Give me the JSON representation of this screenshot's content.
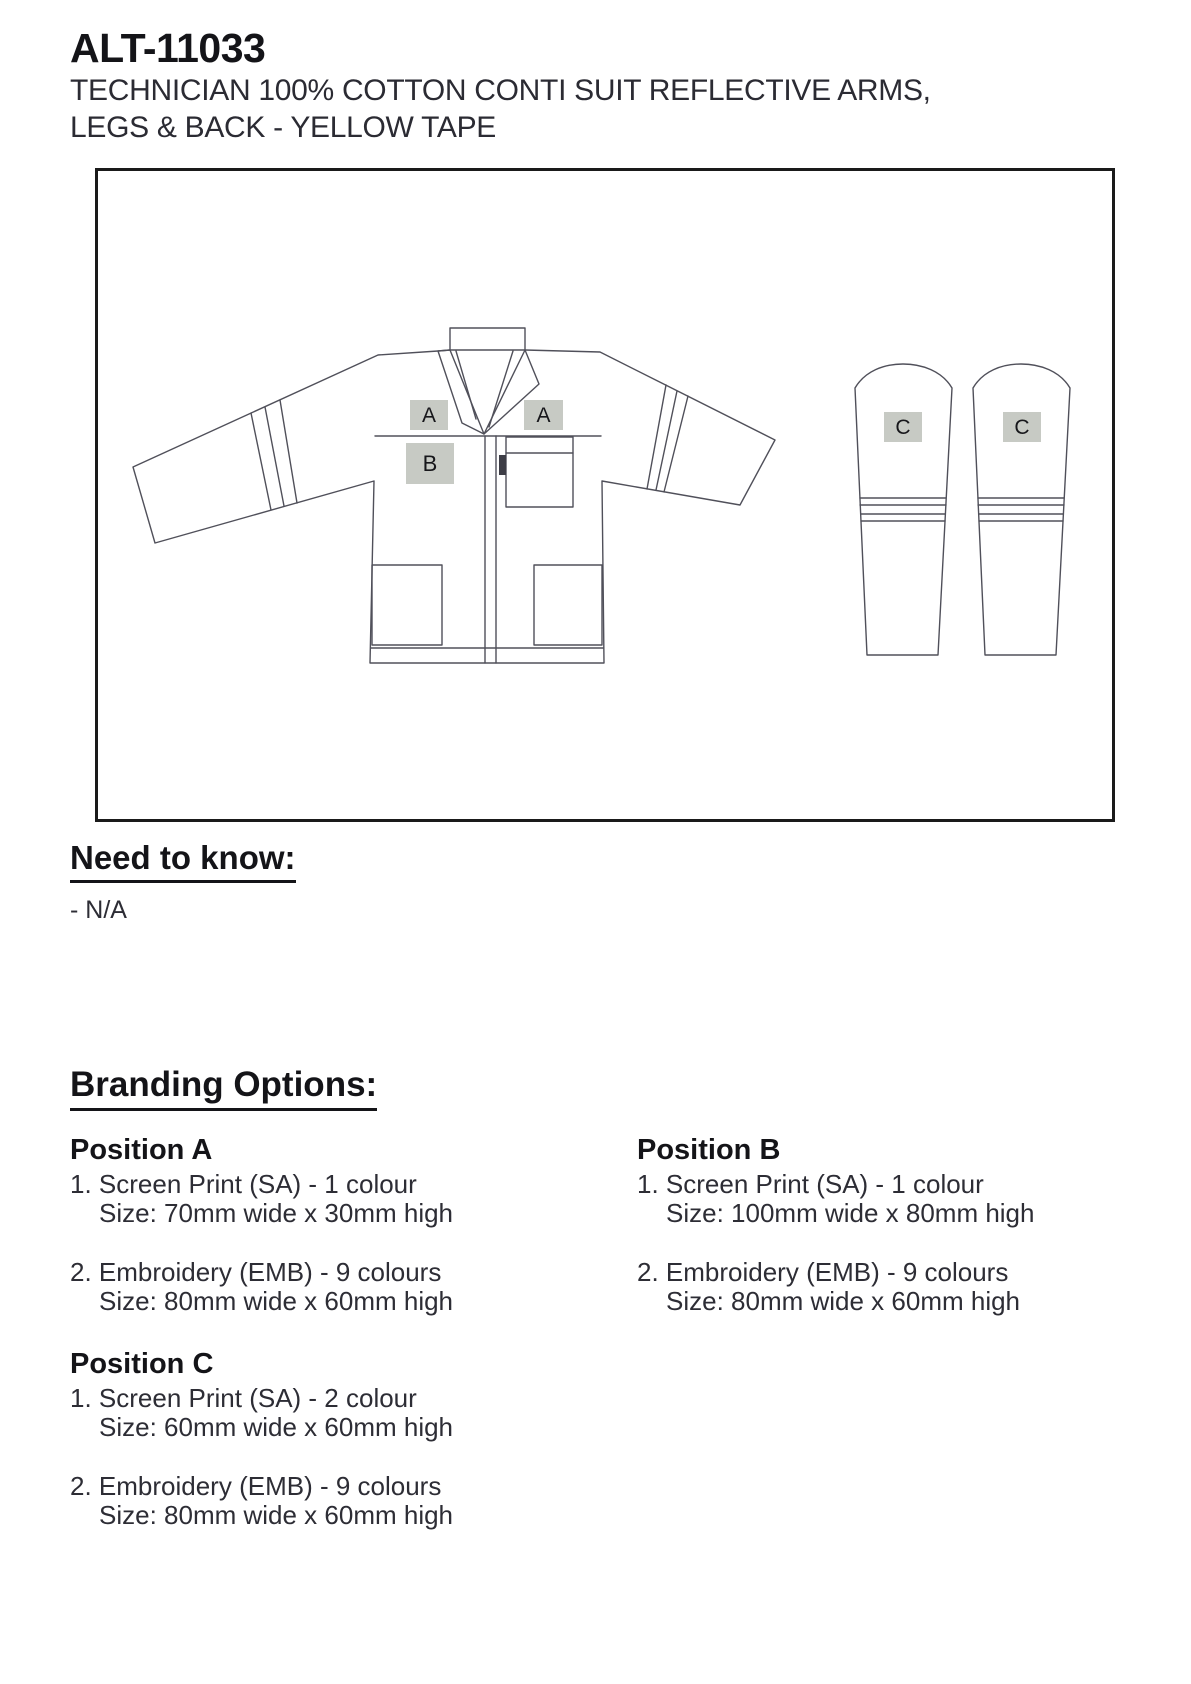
{
  "header": {
    "product_code": "ALT-11033",
    "subtitle_line1": "TECHNICIAN 100% COTTON CONTI SUIT REFLECTIVE ARMS,",
    "subtitle_line2": "LEGS & BACK - YELLOW TAPE"
  },
  "diagram": {
    "markers": {
      "a_left": "A",
      "a_right": "A",
      "b": "B",
      "c_left": "C",
      "c_right": "C"
    },
    "colors": {
      "line": "#50505a",
      "marker_fill": "#c7cac4",
      "frame_border": "#1a1a1a"
    }
  },
  "need_to_know": {
    "heading": "Need to know:",
    "note": "- N/A"
  },
  "branding_options": {
    "heading": "Branding Options:",
    "position_a": {
      "name": "Position A",
      "option1_label": "1. Screen Print (SA) - 1 colour",
      "option1_size": "Size: 70mm wide x 30mm high",
      "option2_label": "2. Embroidery (EMB) - 9 colours",
      "option2_size": "Size: 80mm wide x 60mm high"
    },
    "position_b": {
      "name": "Position B",
      "option1_label": "1. Screen Print (SA) - 1 colour",
      "option1_size": "Size: 100mm wide x 80mm high",
      "option2_label": "2. Embroidery (EMB) - 9 colours",
      "option2_size": "Size: 80mm wide x 60mm high"
    },
    "position_c": {
      "name": "Position C",
      "option1_label": "1. Screen Print (SA) - 2 colour",
      "option1_size": "Size: 60mm wide x 60mm high",
      "option2_label": "2. Embroidery (EMB) - 9 colours",
      "option2_size": "Size: 80mm wide x 60mm high"
    }
  }
}
